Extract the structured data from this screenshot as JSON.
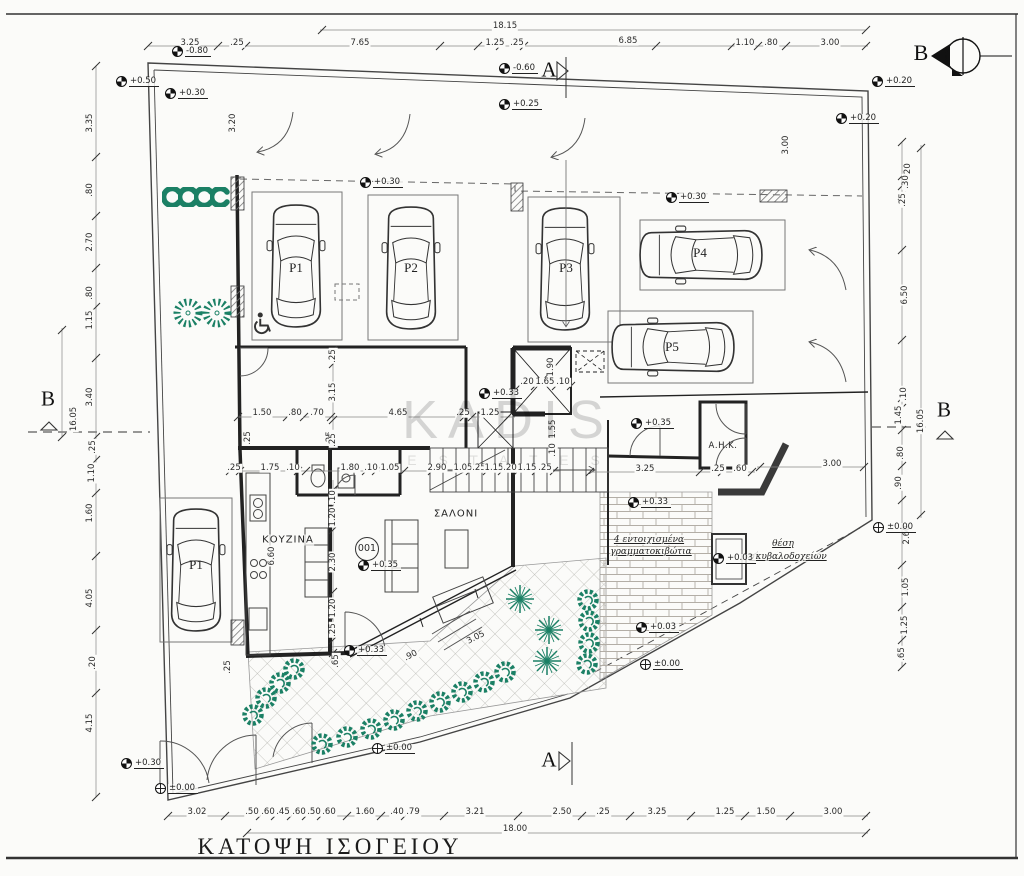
{
  "title": {
    "label": "ΚΑΤΟΨΗ ΙΣΟΓΕΙΟΥ"
  },
  "watermark": {
    "line1": "KADIS",
    "line2": "E S T A T E S"
  },
  "north": {
    "label": "B"
  },
  "unit": {
    "number": "001",
    "x": 367,
    "y": 549
  },
  "colors": {
    "plant": "#1b8065",
    "wall": "#222222",
    "paper": "#fbfbf9",
    "hatch": "#777777"
  },
  "sections": [
    {
      "label": "A",
      "x": 549,
      "y": 70
    },
    {
      "label": "A",
      "x": 549,
      "y": 760
    },
    {
      "label": "B",
      "x": 48,
      "y": 399
    },
    {
      "label": "B",
      "x": 944,
      "y": 410
    }
  ],
  "parking": [
    {
      "label": "P1",
      "x": 196,
      "y": 565
    },
    {
      "label": "P1",
      "x": 296,
      "y": 268
    },
    {
      "label": "P2",
      "x": 411,
      "y": 268
    },
    {
      "label": "P3",
      "x": 566,
      "y": 268
    },
    {
      "label": "P4",
      "x": 700,
      "y": 253
    },
    {
      "label": "P5",
      "x": 672,
      "y": 347
    }
  ],
  "texts": [
    {
      "t": "ΚΟΥΖΙΝΑ",
      "x": 288,
      "y": 540,
      "cls": "room"
    },
    {
      "t": "ΣΑΛΟΝΙ",
      "x": 456,
      "y": 514,
      "cls": "room"
    },
    {
      "t": "Α.Η.Κ.",
      "x": 723,
      "y": 446,
      "cls": "roomsm"
    },
    {
      "t": "4 εντοιχισμένα",
      "x": 649,
      "y": 540,
      "cls": "note"
    },
    {
      "t": "γραμματοκιβώτια",
      "x": 651,
      "y": 552,
      "cls": "note"
    },
    {
      "t": "θέση",
      "x": 783,
      "y": 544,
      "cls": "note"
    },
    {
      "t": "σκυβαλοδοχείων",
      "x": 788,
      "y": 557,
      "cls": "note"
    }
  ],
  "levels": [
    {
      "t": "-0.80",
      "x": 172,
      "y": 55
    },
    {
      "t": "+0.50",
      "x": 116,
      "y": 85
    },
    {
      "t": "+0.30",
      "x": 165,
      "y": 97
    },
    {
      "t": "-0.60",
      "x": 499,
      "y": 72
    },
    {
      "t": "+0.25",
      "x": 499,
      "y": 108
    },
    {
      "t": "+0.20",
      "x": 872,
      "y": 85
    },
    {
      "t": "+0.20",
      "x": 836,
      "y": 122
    },
    {
      "t": "+0.30",
      "x": 360,
      "y": 186
    },
    {
      "t": "+0.30",
      "x": 666,
      "y": 201
    },
    {
      "t": "+0.33",
      "x": 479,
      "y": 397
    },
    {
      "t": "+0.35",
      "x": 631,
      "y": 427
    },
    {
      "t": "+0.33",
      "x": 628,
      "y": 506
    },
    {
      "t": "+0.35",
      "x": 358,
      "y": 569
    },
    {
      "t": "+0.03",
      "x": 713,
      "y": 562
    },
    {
      "t": "+0.33",
      "x": 344,
      "y": 654
    },
    {
      "t": "+0.03",
      "x": 636,
      "y": 631
    },
    {
      "t": "±0.00",
      "x": 640,
      "y": 668,
      "open": true
    },
    {
      "t": "±0.00",
      "x": 372,
      "y": 752,
      "open": true
    },
    {
      "t": "+0.30",
      "x": 121,
      "y": 767
    },
    {
      "t": "±0.00",
      "x": 155,
      "y": 792,
      "open": true
    },
    {
      "t": "±0.00",
      "x": 873,
      "y": 531,
      "open": true
    }
  ],
  "dims": [
    {
      "t": "18.15",
      "x": 505,
      "y": 26
    },
    {
      "t": "3.25",
      "x": 190,
      "y": 43
    },
    {
      "t": ".25",
      "x": 237,
      "y": 43
    },
    {
      "t": "7.65",
      "x": 360,
      "y": 43
    },
    {
      "t": "1.25",
      "x": 495,
      "y": 43
    },
    {
      "t": ".25",
      "x": 517,
      "y": 43
    },
    {
      "t": "6.85",
      "x": 628,
      "y": 41
    },
    {
      "t": "1.10",
      "x": 745,
      "y": 43
    },
    {
      "t": ".80",
      "x": 771,
      "y": 43
    },
    {
      "t": "3.00",
      "x": 830,
      "y": 43
    },
    {
      "t": "3.35",
      "x": 90,
      "y": 123,
      "k": "r"
    },
    {
      "t": ".80",
      "x": 90,
      "y": 190,
      "k": "r"
    },
    {
      "t": "2.70",
      "x": 90,
      "y": 242,
      "k": "r"
    },
    {
      "t": ".80",
      "x": 90,
      "y": 293,
      "k": "r"
    },
    {
      "t": "1.15",
      "x": 90,
      "y": 320,
      "k": "r"
    },
    {
      "t": "3.40",
      "x": 90,
      "y": 397,
      "k": "r"
    },
    {
      "t": "16.05",
      "x": 74,
      "y": 419,
      "k": "r"
    },
    {
      "t": ".25",
      "x": 93,
      "y": 447,
      "k": "r"
    },
    {
      "t": "1.10",
      "x": 92,
      "y": 473,
      "k": "r"
    },
    {
      "t": "1.60",
      "x": 90,
      "y": 513,
      "k": "r"
    },
    {
      "t": "4.05",
      "x": 90,
      "y": 598,
      "k": "r"
    },
    {
      "t": ".20",
      "x": 93,
      "y": 663,
      "k": "r"
    },
    {
      "t": "4.15",
      "x": 90,
      "y": 723,
      "k": "r"
    },
    {
      "t": "3.20",
      "x": 233,
      "y": 123,
      "k": "r"
    },
    {
      "t": ".20",
      "x": 908,
      "y": 170,
      "k": "r"
    },
    {
      "t": ".30",
      "x": 906,
      "y": 182,
      "k": "r"
    },
    {
      "t": ".25",
      "x": 903,
      "y": 200,
      "k": "r"
    },
    {
      "t": "6.50",
      "x": 905,
      "y": 295,
      "k": "r"
    },
    {
      "t": "3.00",
      "x": 786,
      "y": 145,
      "k": "r"
    },
    {
      "t": ".10",
      "x": 904,
      "y": 394,
      "k": "r"
    },
    {
      "t": "1.45",
      "x": 899,
      "y": 415,
      "k": "r"
    },
    {
      "t": "16.05",
      "x": 921,
      "y": 421,
      "k": "r"
    },
    {
      "t": ".80",
      "x": 901,
      "y": 453,
      "k": "r"
    },
    {
      "t": ".90",
      "x": 899,
      "y": 483,
      "k": "r"
    },
    {
      "t": "2.60",
      "x": 907,
      "y": 535,
      "k": "r"
    },
    {
      "t": "1.05",
      "x": 906,
      "y": 587,
      "k": "r"
    },
    {
      "t": "1.25",
      "x": 905,
      "y": 625,
      "k": "r"
    },
    {
      "t": ".65",
      "x": 902,
      "y": 654,
      "k": "r"
    },
    {
      "t": "3.02",
      "x": 197,
      "y": 812
    },
    {
      "t": ".50",
      "x": 252,
      "y": 812
    },
    {
      "t": ".60",
      "x": 268,
      "y": 812
    },
    {
      "t": ".45",
      "x": 283,
      "y": 812
    },
    {
      "t": ".60",
      "x": 299,
      "y": 812
    },
    {
      "t": ".50",
      "x": 314,
      "y": 812
    },
    {
      "t": ".60",
      "x": 329,
      "y": 812
    },
    {
      "t": "1.60",
      "x": 365,
      "y": 812
    },
    {
      "t": ".40",
      "x": 397,
      "y": 812
    },
    {
      "t": ".79",
      "x": 413,
      "y": 812
    },
    {
      "t": "3.21",
      "x": 475,
      "y": 812
    },
    {
      "t": "2.50",
      "x": 562,
      "y": 812
    },
    {
      "t": ".25",
      "x": 603,
      "y": 812
    },
    {
      "t": "3.25",
      "x": 657,
      "y": 812
    },
    {
      "t": "1.25",
      "x": 725,
      "y": 812
    },
    {
      "t": "1.50",
      "x": 766,
      "y": 812
    },
    {
      "t": "3.00",
      "x": 833,
      "y": 812
    },
    {
      "t": "18.00",
      "x": 515,
      "y": 829
    },
    {
      "t": "1.50",
      "x": 262,
      "y": 413
    },
    {
      "t": ".80",
      "x": 295,
      "y": 413
    },
    {
      "t": ".70",
      "x": 317,
      "y": 413
    },
    {
      "t": "4.65",
      "x": 398,
      "y": 413
    },
    {
      "t": ".25",
      "x": 463,
      "y": 413
    },
    {
      "t": "1.25",
      "x": 490,
      "y": 413
    },
    {
      "t": ".25",
      "x": 234,
      "y": 468
    },
    {
      "t": "1.75",
      "x": 270,
      "y": 468
    },
    {
      "t": ".10",
      "x": 293,
      "y": 468
    },
    {
      "t": "1.80",
      "x": 350,
      "y": 468
    },
    {
      "t": ".10",
      "x": 371,
      "y": 468
    },
    {
      "t": "1.05",
      "x": 390,
      "y": 468
    },
    {
      "t": "2.90",
      "x": 437,
      "y": 468
    },
    {
      "t": "1.05",
      "x": 463,
      "y": 468
    },
    {
      "t": ".25",
      "x": 479,
      "y": 468
    },
    {
      "t": "1.15",
      "x": 494,
      "y": 468
    },
    {
      "t": ".20",
      "x": 510,
      "y": 468
    },
    {
      "t": "1.15",
      "x": 527,
      "y": 468
    },
    {
      "t": ".25",
      "x": 545,
      "y": 468
    },
    {
      "t": "3.25",
      "x": 645,
      "y": 469
    },
    {
      "t": ".25",
      "x": 718,
      "y": 469
    },
    {
      "t": ".60",
      "x": 740,
      "y": 469
    },
    {
      "t": "3.00",
      "x": 832,
      "y": 464
    },
    {
      "t": ".20",
      "x": 527,
      "y": 382
    },
    {
      "t": "1.65",
      "x": 545,
      "y": 382
    },
    {
      "t": ".10",
      "x": 563,
      "y": 382
    },
    {
      "t": "1.90",
      "x": 551,
      "y": 367,
      "k": "r"
    },
    {
      "t": "1.55",
      "x": 553,
      "y": 429,
      "k": "r"
    },
    {
      "t": ".10",
      "x": 553,
      "y": 450,
      "k": "r"
    },
    {
      "t": "6.60",
      "x": 272,
      "y": 556,
      "k": "r"
    },
    {
      "t": ".25",
      "x": 248,
      "y": 438,
      "k": "r"
    },
    {
      "t": ".25",
      "x": 330,
      "y": 438,
      "k": "r"
    },
    {
      "t": ".25",
      "x": 333,
      "y": 356,
      "k": "r"
    },
    {
      "t": "3.15",
      "x": 333,
      "y": 392,
      "k": "r"
    },
    {
      "t": ".25",
      "x": 333,
      "y": 440,
      "k": "r"
    },
    {
      "t": ".10",
      "x": 333,
      "y": 497,
      "k": "r"
    },
    {
      "t": "1.20",
      "x": 333,
      "y": 517,
      "k": "r"
    },
    {
      "t": "2.30",
      "x": 333,
      "y": 562,
      "k": "r"
    },
    {
      "t": "1.20",
      "x": 333,
      "y": 608,
      "k": "r"
    },
    {
      "t": ".25",
      "x": 333,
      "y": 630,
      "k": "r"
    },
    {
      "t": ".65",
      "x": 336,
      "y": 661,
      "k": "r"
    },
    {
      "t": ".25",
      "x": 228,
      "y": 667,
      "k": "r"
    },
    {
      "t": "3.05",
      "x": 476,
      "y": 638,
      "k": "d"
    },
    {
      "t": ".90",
      "x": 411,
      "y": 656,
      "k": "d"
    }
  ]
}
